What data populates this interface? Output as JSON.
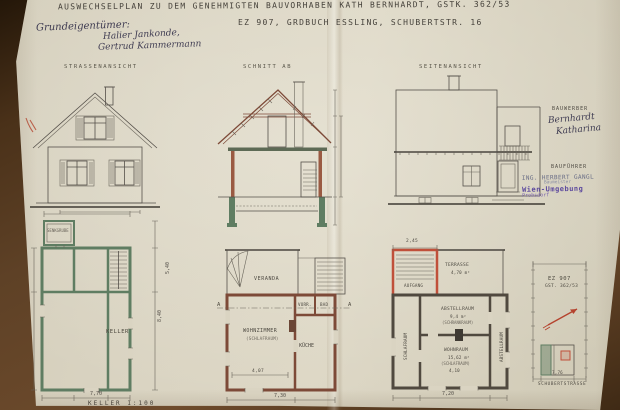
{
  "header": {
    "title_line1": "AUSWECHSELPLAN ZU DEM GENEHMIGTEN BAUVORHABEN KATH BERNHARDT, GSTK. 362/53",
    "title_line2": "EZ 907, GRDBUCH ESSLING, SCHUBERTSTR. 16",
    "owner_label": "Grundeigentümer:",
    "owner_name1": "Halier Jankonde,",
    "owner_name2": "Gertrud Kammermann"
  },
  "views": {
    "front_label": "STRASSENANSICHT",
    "section_label": "SCHNITT AB",
    "side_label": "SEITENANSICHT"
  },
  "parties": {
    "bauwerber_label": "BAUWERBER",
    "bauwerber_name1": "Bernhardt",
    "bauwerber_name2": "Katharina",
    "baufuehrer_label": "BAUFÜHRER",
    "stamp_line1": "ING. HERBERT GANGL",
    "stamp_line2": "Baumeister",
    "stamp_line3": "Wien-Umgebung",
    "stamp_line4": "Probsdorf"
  },
  "keller_plan": {
    "outbuilding_label": "SENKGRUBE",
    "room_label": "KELLER",
    "dim_bottom": "7,70",
    "dim_right": "8,40",
    "dim_right_upper": "5,40",
    "caption": "KELLER 1:100"
  },
  "eg_plan": {
    "veranda_label": "VERANDA",
    "room_main_label": "WOHNZIMMER",
    "room_main_sub": "(SCHLAFRAUM)",
    "kitchen_label": "KÜCHE",
    "small_room1_label": "VORR.",
    "small_room2_label": "BAD",
    "dim_bottom": "7,30",
    "dim_inner": "4,07",
    "section_mark_left": "A",
    "section_mark_right": "A"
  },
  "og_plan": {
    "terrace_label": "TERRASSE",
    "terrace_area": "4,70 m²",
    "stair_label": "AUFGANG",
    "room_mid_label": "ABSTELLRAUM",
    "room_mid_area": "9,4 m²",
    "room_mid_sub": "(SCHRANKRAUM)",
    "room_bottom_label": "WOHNRAUM",
    "room_bottom_area": "15,62 m²",
    "room_bottom_sub": "(SCHLAFRAUM)",
    "room_left_label": "SCHLAFRAUM",
    "room_right_label": "ABSTELLRAUM",
    "dim_top": "2,45",
    "dim_inner": "4,10",
    "dim_bottom": "7,20"
  },
  "site_plan": {
    "parcel_label": "EZ 907",
    "gst_label": "GST. 362/53",
    "dim_bottom": "7,76",
    "street_label": "SCHUBERTSTRASSE"
  },
  "colors": {
    "paper": "#d9d3c1",
    "ink": "#55504a",
    "wall_green": "#5f7d62",
    "wall_brown": "#7d4a38",
    "mark_red": "#b5432e",
    "stamp_blue": "#6a6e86",
    "stamp_purple": "#5d4a9e",
    "background_brown": "#5e4126"
  }
}
